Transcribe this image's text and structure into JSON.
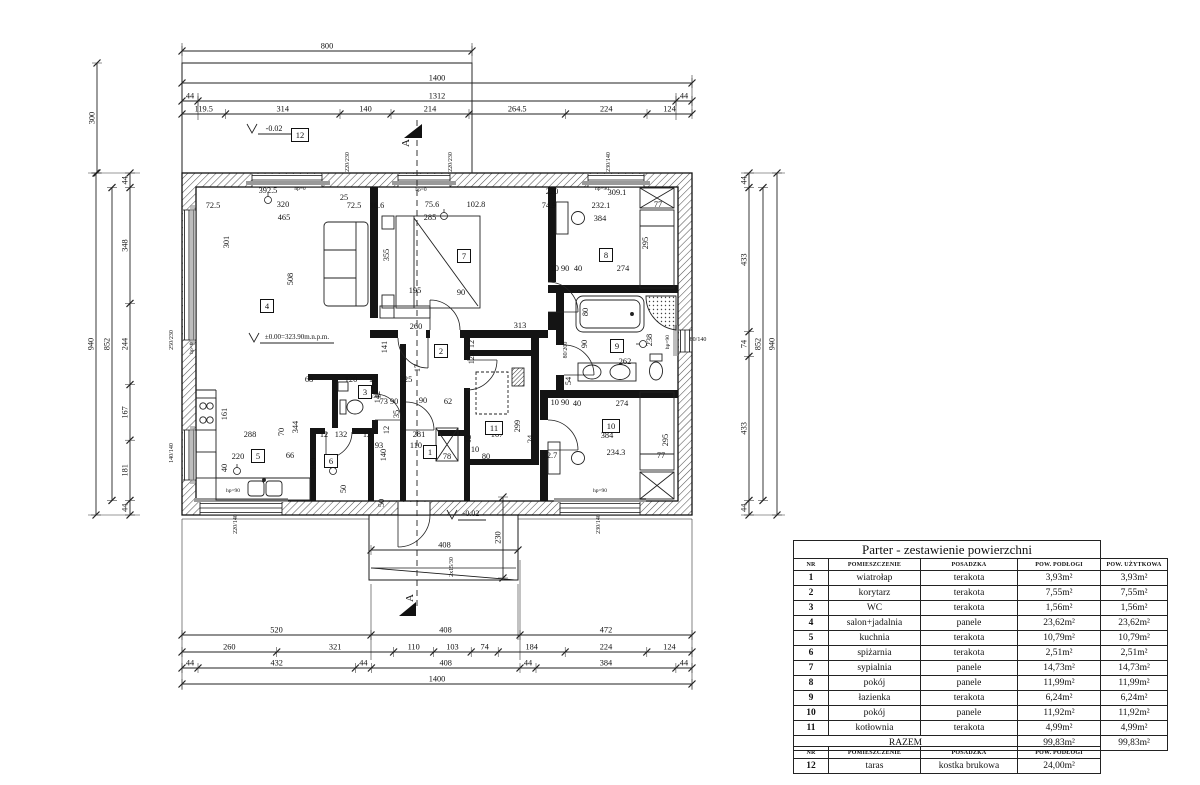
{
  "drawing": {
    "rooms": [
      {
        "n": "1",
        "x": 430,
        "y": 452
      },
      {
        "n": "2",
        "x": 441,
        "y": 351
      },
      {
        "n": "3",
        "x": 365,
        "y": 392
      },
      {
        "n": "4",
        "x": 267,
        "y": 306
      },
      {
        "n": "5",
        "x": 258,
        "y": 456
      },
      {
        "n": "6",
        "x": 331,
        "y": 461
      },
      {
        "n": "7",
        "x": 464,
        "y": 256
      },
      {
        "n": "8",
        "x": 606,
        "y": 255
      },
      {
        "n": "9",
        "x": 617,
        "y": 346
      },
      {
        "n": "10",
        "x": 611,
        "y": 426
      },
      {
        "n": "11",
        "x": 494,
        "y": 428
      },
      {
        "n": "12",
        "x": 300,
        "y": 135
      }
    ],
    "labels": [
      {
        "x": 268,
        "y": 193,
        "t": "392.5"
      },
      {
        "x": 283,
        "y": 207,
        "t": "320"
      },
      {
        "x": 213,
        "y": 208,
        "t": "72.5"
      },
      {
        "x": 284,
        "y": 220,
        "t": "465"
      },
      {
        "x": 229,
        "y": 242,
        "t": "301",
        "r": 1
      },
      {
        "x": 293,
        "y": 279,
        "t": "508",
        "r": 1
      },
      {
        "x": 344,
        "y": 200,
        "t": "25"
      },
      {
        "x": 354,
        "y": 208,
        "t": "72.5"
      },
      {
        "x": 377,
        "y": 208,
        "t": "16.6"
      },
      {
        "x": 432,
        "y": 207,
        "t": "75.6"
      },
      {
        "x": 430,
        "y": 220,
        "t": "285"
      },
      {
        "x": 476,
        "y": 207,
        "t": "102.8"
      },
      {
        "x": 389,
        "y": 255,
        "t": "355",
        "r": 1
      },
      {
        "x": 415,
        "y": 293,
        "t": "195"
      },
      {
        "x": 461,
        "y": 295,
        "t": "90"
      },
      {
        "x": 416,
        "y": 329,
        "t": "260"
      },
      {
        "x": 520,
        "y": 328,
        "t": "313"
      },
      {
        "x": 387,
        "y": 347,
        "t": "141",
        "r": 1
      },
      {
        "x": 552,
        "y": 194,
        "t": "220"
      },
      {
        "x": 617,
        "y": 195,
        "t": "309.1"
      },
      {
        "x": 549,
        "y": 208,
        "t": "74.9"
      },
      {
        "x": 601,
        "y": 208,
        "t": "232.1"
      },
      {
        "x": 600,
        "y": 221,
        "t": "384"
      },
      {
        "x": 658,
        "y": 207,
        "t": "77"
      },
      {
        "x": 648,
        "y": 243,
        "t": "295",
        "r": 1
      },
      {
        "x": 560,
        "y": 271,
        "t": "10 90"
      },
      {
        "x": 578,
        "y": 271,
        "t": "40"
      },
      {
        "x": 623,
        "y": 271,
        "t": "274"
      },
      {
        "x": 300,
        "y": 190,
        "t": "hp=0",
        "s": 5.5
      },
      {
        "x": 421,
        "y": 191,
        "t": "hp=0",
        "s": 5.5
      },
      {
        "x": 602,
        "y": 190,
        "t": "hp=90",
        "s": 5.5
      },
      {
        "x": 233,
        "y": 492,
        "t": "hp=90",
        "s": 5.5
      },
      {
        "x": 600,
        "y": 492,
        "t": "hp=90",
        "s": 5.5
      },
      {
        "x": 669,
        "y": 342,
        "t": "hp=90",
        "r": 1,
        "s": 5.5
      },
      {
        "x": 193,
        "y": 348,
        "t": "hp=0",
        "r": 1,
        "s": 5.5
      },
      {
        "x": 297,
        "y": 339,
        "t": "±0.00=323.90m.n.p.m.",
        "s": 7
      },
      {
        "x": 274,
        "y": 131,
        "t": "-0.02",
        "s": 8
      },
      {
        "x": 471,
        "y": 516,
        "t": "-0.02",
        "s": 8
      },
      {
        "x": 453,
        "y": 567,
        "t": "2x15/30",
        "r": 1,
        "s": 6
      },
      {
        "x": 409,
        "y": 143,
        "t": "A",
        "r": 1,
        "s": 11
      },
      {
        "x": 413,
        "y": 598,
        "t": "A",
        "r": 1,
        "s": 11
      },
      {
        "x": 384,
        "y": 503,
        "t": "50",
        "r": 1
      },
      {
        "x": 173,
        "y": 340,
        "t": "250/230",
        "r": 1,
        "s": 6
      },
      {
        "x": 173,
        "y": 453,
        "t": "140/140",
        "r": 1,
        "s": 6
      },
      {
        "x": 349,
        "y": 162,
        "t": "220/230",
        "r": 1,
        "s": 6
      },
      {
        "x": 452,
        "y": 162,
        "t": "220/230",
        "r": 1,
        "s": 6
      },
      {
        "x": 610,
        "y": 162,
        "t": "230/140",
        "r": 1,
        "s": 6
      },
      {
        "x": 237,
        "y": 524,
        "t": "220/140",
        "r": 1,
        "s": 6
      },
      {
        "x": 600,
        "y": 524,
        "t": "230/140",
        "r": 1,
        "s": 6
      },
      {
        "x": 698,
        "y": 341,
        "t": "80/140",
        "s": 6
      },
      {
        "x": 567,
        "y": 350,
        "t": "80/200",
        "r": 1,
        "s": 6
      },
      {
        "x": 374,
        "y": 398,
        "t": "60/200",
        "s": 5
      },
      {
        "x": 309,
        "y": 382,
        "t": "68"
      },
      {
        "x": 351,
        "y": 382,
        "t": "120"
      },
      {
        "x": 373,
        "y": 382,
        "t": "12"
      },
      {
        "x": 406,
        "y": 382,
        "t": "225"
      },
      {
        "x": 389,
        "y": 404,
        "t": "73 90"
      },
      {
        "x": 399,
        "y": 414,
        "t": "35",
        "r": 1
      },
      {
        "x": 423,
        "y": 403,
        "t": "90"
      },
      {
        "x": 448,
        "y": 404,
        "t": "62"
      },
      {
        "x": 380,
        "y": 397,
        "t": "142",
        "r": 1
      },
      {
        "x": 389,
        "y": 430,
        "t": "12",
        "r": 1
      },
      {
        "x": 419,
        "y": 437,
        "t": "281"
      },
      {
        "x": 497,
        "y": 437,
        "t": "167"
      },
      {
        "x": 471,
        "y": 439,
        "t": "12",
        "r": 1
      },
      {
        "x": 533,
        "y": 439,
        "t": "24",
        "r": 1
      },
      {
        "x": 520,
        "y": 426,
        "t": "299",
        "r": 1
      },
      {
        "x": 250,
        "y": 437,
        "t": "288"
      },
      {
        "x": 284,
        "y": 432,
        "t": "70",
        "r": 1
      },
      {
        "x": 298,
        "y": 427,
        "t": "344",
        "r": 1
      },
      {
        "x": 341,
        "y": 437,
        "t": "132"
      },
      {
        "x": 324,
        "y": 437,
        "t": "12"
      },
      {
        "x": 367,
        "y": 437,
        "t": "12"
      },
      {
        "x": 227,
        "y": 414,
        "t": "161",
        "r": 1
      },
      {
        "x": 238,
        "y": 459,
        "t": "220"
      },
      {
        "x": 227,
        "y": 468,
        "t": "40",
        "r": 1
      },
      {
        "x": 290,
        "y": 458,
        "t": "66"
      },
      {
        "x": 316,
        "y": 464,
        "t": "190",
        "r": 1
      },
      {
        "x": 346,
        "y": 489,
        "t": "50",
        "r": 1
      },
      {
        "x": 379,
        "y": 448,
        "t": "93"
      },
      {
        "x": 386,
        "y": 455,
        "t": "140",
        "r": 1
      },
      {
        "x": 416,
        "y": 448,
        "t": "110"
      },
      {
        "x": 447,
        "y": 459,
        "t": "78"
      },
      {
        "x": 475,
        "y": 452,
        "t": "10"
      },
      {
        "x": 486,
        "y": 459,
        "t": "80"
      },
      {
        "x": 550,
        "y": 458,
        "t": "72.7"
      },
      {
        "x": 616,
        "y": 455,
        "t": "234.3"
      },
      {
        "x": 607,
        "y": 438,
        "t": "384"
      },
      {
        "x": 661,
        "y": 458,
        "t": "77"
      },
      {
        "x": 668,
        "y": 440,
        "t": "295",
        "r": 1
      },
      {
        "x": 588,
        "y": 312,
        "t": "80",
        "r": 1
      },
      {
        "x": 587,
        "y": 344,
        "t": "90",
        "r": 1
      },
      {
        "x": 652,
        "y": 340,
        "t": "238",
        "r": 1
      },
      {
        "x": 625,
        "y": 364,
        "t": "262"
      },
      {
        "x": 571,
        "y": 381,
        "t": "54",
        "r": 1
      },
      {
        "x": 577,
        "y": 406,
        "t": "40"
      },
      {
        "x": 560,
        "y": 405,
        "t": "10 90"
      },
      {
        "x": 622,
        "y": 406,
        "t": "274"
      },
      {
        "x": 420,
        "y": 368,
        "t": "17",
        "r": 1
      },
      {
        "x": 474,
        "y": 344,
        "t": "12",
        "r": 1
      },
      {
        "x": 474,
        "y": 358,
        "t": "124",
        "r": 1
      }
    ],
    "dim_chains": [
      {
        "dir": "h",
        "y": 51,
        "ticks": [
          182,
          472
        ],
        "labels": [
          "800"
        ]
      },
      {
        "dir": "h",
        "y": 83,
        "ticks": [
          182,
          692
        ],
        "labels": [
          "1400"
        ]
      },
      {
        "dir": "h",
        "y": 101,
        "ticks": [
          182,
          198,
          676,
          692
        ],
        "labels": [
          "44",
          "1312",
          "44"
        ]
      },
      {
        "dir": "h",
        "y": 114,
        "ticks": [
          182,
          225.5,
          340,
          391,
          469,
          565.5,
          647,
          692
        ],
        "labels": [
          "119.5",
          "314",
          "140",
          "214",
          "264.5",
          "224",
          "124"
        ]
      },
      {
        "dir": "h",
        "y": 635,
        "ticks": [
          182,
          371,
          520,
          692
        ],
        "labels": [
          "520",
          "408",
          "472"
        ]
      },
      {
        "dir": "h",
        "y": 652,
        "ticks": [
          182,
          276.7,
          393.6,
          433.7,
          471.2,
          498.2,
          565.2,
          646.8,
          692
        ],
        "labels": [
          "260",
          "321",
          "110",
          "103",
          "74",
          "184",
          "224",
          "124"
        ]
      },
      {
        "dir": "h",
        "y": 668,
        "ticks": [
          182,
          198,
          355.4,
          371.4,
          520,
          536,
          675.9,
          692
        ],
        "labels": [
          "44",
          "432",
          "44",
          "408",
          "44",
          "384",
          "44"
        ]
      },
      {
        "dir": "h",
        "y": 684,
        "ticks": [
          182,
          692
        ],
        "labels": [
          "1400"
        ]
      },
      {
        "dir": "h",
        "y": 550,
        "ticks": [
          371,
          518
        ],
        "labels": [
          "408"
        ]
      },
      {
        "dir": "v",
        "x": 97,
        "ticks": [
          63,
          173
        ],
        "labels": [
          "300"
        ]
      },
      {
        "dir": "v",
        "x": 130,
        "ticks": [
          173,
          187.6,
          303.4,
          384.6,
          440.2,
          500.4,
          515
        ],
        "labels": [
          "44",
          "348",
          "244",
          "167",
          "181",
          "44"
        ]
      },
      {
        "dir": "v",
        "x": 112,
        "ticks": [
          187.6,
          500.4
        ],
        "labels": [
          "852"
        ]
      },
      {
        "dir": "v",
        "x": 96,
        "ticks": [
          173,
          515
        ],
        "labels": [
          "940"
        ]
      },
      {
        "dir": "v",
        "x": 749,
        "ticks": [
          173,
          187.6,
          331.7,
          356.3,
          500.4,
          515
        ],
        "labels": [
          "44",
          "433",
          "74",
          "433",
          "44"
        ]
      },
      {
        "dir": "v",
        "x": 763,
        "ticks": [
          187.6,
          500.4
        ],
        "labels": [
          "852"
        ]
      },
      {
        "dir": "v",
        "x": 777,
        "ticks": [
          173,
          515
        ],
        "labels": [
          "940"
        ]
      },
      {
        "dir": "v",
        "x": 503,
        "ticks": [
          497,
          578
        ],
        "labels": [
          "230"
        ]
      }
    ]
  },
  "area_table": {
    "title": "Parter - zestawienie powierzchni",
    "headers": [
      "NR",
      "POMIESZCZENIE",
      "POSADZKA",
      "POW. PODŁOGI",
      "POW. UŻYTKOWA"
    ],
    "rows": [
      [
        "1",
        "wiatrołap",
        "terakota",
        "3,93m²",
        "3,93m²"
      ],
      [
        "2",
        "korytarz",
        "terakota",
        "7,55m²",
        "7,55m²"
      ],
      [
        "3",
        "WC",
        "terakota",
        "1,56m²",
        "1,56m²"
      ],
      [
        "4",
        "salon+jadalnia",
        "panele",
        "23,62m²",
        "23,62m²"
      ],
      [
        "5",
        "kuchnia",
        "terakota",
        "10,79m²",
        "10,79m²"
      ],
      [
        "6",
        "spiżarnia",
        "terakota",
        "2,51m²",
        "2,51m²"
      ],
      [
        "7",
        "sypialnia",
        "panele",
        "14,73m²",
        "14,73m²"
      ],
      [
        "8",
        "pokój",
        "panele",
        "11,99m²",
        "11,99m²"
      ],
      [
        "9",
        "łazienka",
        "terakota",
        "6,24m²",
        "6,24m²"
      ],
      [
        "10",
        "pokój",
        "panele",
        "11,92m²",
        "11,92m²"
      ],
      [
        "11",
        "kotłownia",
        "terakota",
        "4,99m²",
        "4,99m²"
      ]
    ],
    "total_label": "RAZEM",
    "total_podlogi": "99,83m²",
    "total_uzytkowa": "99,83m²"
  },
  "terrace_table": {
    "headers": [
      "NR",
      "POMIESZCZENIE",
      "POSADZKA",
      "POW. PODŁOGI"
    ],
    "rows": [
      [
        "12",
        "taras",
        "kostka brukowa",
        "24,00m²"
      ]
    ]
  }
}
